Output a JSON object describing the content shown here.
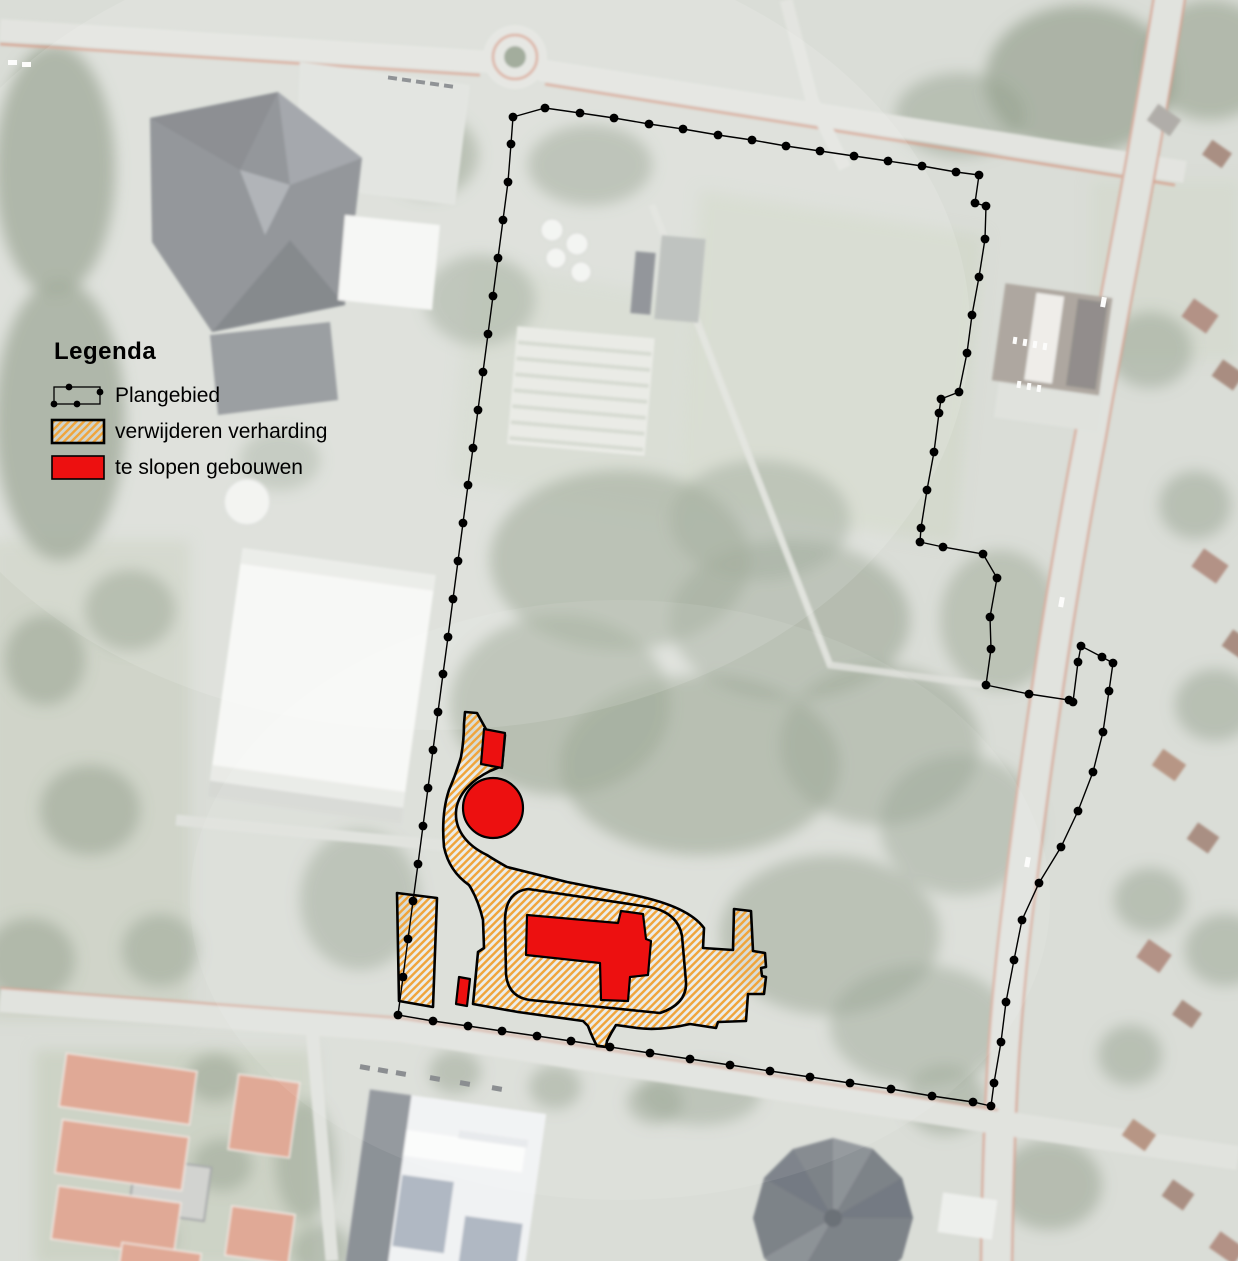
{
  "legend": {
    "title": "Legenda",
    "items": [
      {
        "id": "plangebied",
        "label": "Plangebied",
        "swatch": "dotted-boundary-rect"
      },
      {
        "id": "verharding",
        "label": "verwijderen verharding",
        "swatch": "orange-diagonal-hatch"
      },
      {
        "id": "slopen",
        "label": "te slopen gebouwen",
        "swatch": "solid-red-rect"
      }
    ]
  },
  "colors": {
    "hatch_stripe": "#F0A53C",
    "hatch_bg": "rgba(255,255,255,0.42)",
    "demolition_red": "#ED1010",
    "outline_black": "#000000"
  },
  "overlay": {
    "boundary_points": [
      [
        513,
        117
      ],
      [
        545,
        108
      ],
      [
        580,
        113
      ],
      [
        614,
        118
      ],
      [
        649,
        124
      ],
      [
        683,
        129
      ],
      [
        718,
        135
      ],
      [
        752,
        140
      ],
      [
        786,
        146
      ],
      [
        820,
        151
      ],
      [
        854,
        156
      ],
      [
        888,
        161
      ],
      [
        922,
        166
      ],
      [
        956,
        172
      ],
      [
        979,
        175
      ],
      [
        975,
        203
      ],
      [
        986,
        206
      ],
      [
        985,
        239
      ],
      [
        979,
        277
      ],
      [
        972,
        315
      ],
      [
        967,
        353
      ],
      [
        959,
        392
      ],
      [
        941,
        399
      ],
      [
        939,
        413
      ],
      [
        934,
        452
      ],
      [
        927,
        490
      ],
      [
        921,
        528
      ],
      [
        920,
        542
      ],
      [
        943,
        547
      ],
      [
        983,
        554
      ],
      [
        997,
        578
      ],
      [
        990,
        617
      ],
      [
        991,
        649
      ],
      [
        986,
        685
      ],
      [
        1029,
        694
      ],
      [
        1069,
        700
      ],
      [
        1073,
        702
      ],
      [
        1078,
        662
      ],
      [
        1081,
        646
      ],
      [
        1102,
        657
      ],
      [
        1113,
        663
      ],
      [
        1109,
        691
      ],
      [
        1103,
        732
      ],
      [
        1093,
        772
      ],
      [
        1078,
        811
      ],
      [
        1061,
        847
      ],
      [
        1039,
        883
      ],
      [
        1022,
        920
      ],
      [
        1014,
        960
      ],
      [
        1006,
        1002
      ],
      [
        1001,
        1042
      ],
      [
        994,
        1083
      ],
      [
        991,
        1106
      ],
      [
        973,
        1102
      ],
      [
        932,
        1096
      ],
      [
        891,
        1089
      ],
      [
        850,
        1083
      ],
      [
        810,
        1077
      ],
      [
        770,
        1071
      ],
      [
        730,
        1065
      ],
      [
        690,
        1059
      ],
      [
        650,
        1053
      ],
      [
        610,
        1047
      ],
      [
        571,
        1041
      ],
      [
        537,
        1036
      ],
      [
        502,
        1031
      ],
      [
        468,
        1026
      ],
      [
        433,
        1021
      ],
      [
        398,
        1015
      ],
      [
        403,
        977
      ],
      [
        408,
        939
      ],
      [
        413,
        901
      ],
      [
        418,
        864
      ],
      [
        423,
        826
      ],
      [
        428,
        788
      ],
      [
        433,
        750
      ],
      [
        438,
        712
      ],
      [
        443,
        674
      ],
      [
        448,
        637
      ],
      [
        453,
        599
      ],
      [
        458,
        561
      ],
      [
        463,
        523
      ],
      [
        468,
        485
      ],
      [
        473,
        448
      ],
      [
        478,
        410
      ],
      [
        483,
        372
      ],
      [
        488,
        334
      ],
      [
        493,
        296
      ],
      [
        498,
        258
      ],
      [
        503,
        220
      ],
      [
        508,
        182
      ],
      [
        511,
        144
      ]
    ],
    "hatch": {
      "outer": "M465,712 L477,713 L487,731 L505,735 L502,766 L490,771 C474,779 457,793 456,812 C455,831 468,846 487,855 C493,859 500,863 507,867 L567,882 L633,895 Q688,906 704,928 L703,948 L718,949 L733,950 L734,909 L751,911 L753,951 L765,953 L766,967 L761,968 L762,976 L766,977 L764,994 L748,994 L746,1021 L718,1022 L716,1028 L690,1024 Q660,1031 637,1028 L616,1025 Q611,1033 607,1041 L606,1047 L597,1046 Q592,1037 588,1026 L583,1021 L518,1012 L473,1004 L476,973 L478,952 L484,948 L483,920 Q478,899 469,885 Q449,871 444,847 Q441,814 449,790 Q456,774 461,757 Q464,740 464,724 Z",
      "island": "M528,889 L650,907 Q678,913 682,936 L686,982 Q687,1004 660,1013 L530,1000 Q508,997 506,974 L505,924 Q504,892 528,889 Z",
      "strip": "M397,893 L437,898 L433,1007 L399,1001 Z"
    },
    "red": {
      "circle": {
        "cx": 493,
        "cy": 808,
        "r": 30
      },
      "building": "M527,915 L618,923 L621,911 L643,914 L646,939 L651,941 L648,975 L630,977 L628,1001 L601,1000 L600,963 L526,955 Z",
      "rect1": "M484,729 L505,733 L502,768 L481,764 Z",
      "rect2": "M459,977 L470,979 L467,1006 L456,1004 Z"
    }
  }
}
